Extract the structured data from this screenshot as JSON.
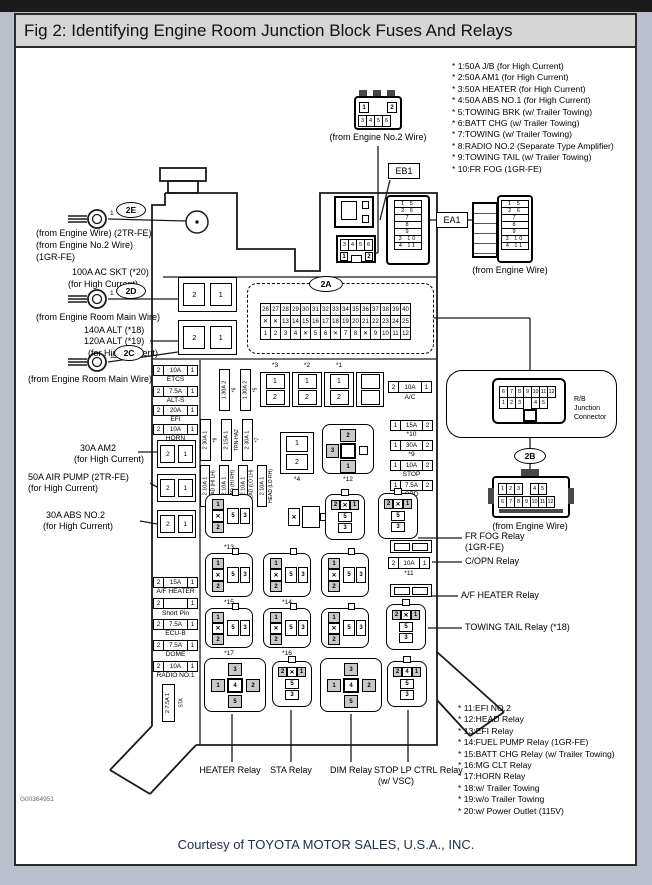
{
  "window": {
    "title": "Fig 2: Identifying Engine Room Junction Block Fuses And Relays"
  },
  "footer": {
    "credit": "Courtesy of TOYOTA MOTOR SALES, U.S.A., INC.",
    "doc_id": "G00364951"
  },
  "legend_top": [
    "* 1:50A J/B (for High Current)",
    "* 2:50A AM1 (for High Current)",
    "* 3:50A HEATER (for High Current)",
    "* 4:50A ABS NO.1 (for High Current)",
    "* 5:TOWING BRK (w/ Trailer Towing)",
    "* 6:BATT CHG (w/ Trailer Towing)",
    "* 7:TOWING (w/ Trailer Towing)",
    "* 8:RADIO NO.2 (Separate Type Amplifier)",
    "* 9:TOWING TAIL (w/ Trailer Towing)",
    "* 10:FR FOG (1GR-FE)"
  ],
  "legend_bottom": [
    "* 11:EFI NO.2",
    "* 12:HEAD Relay",
    "* 13:EFI Relay",
    "* 14:FUEL PUMP Relay (1GR-FE)",
    "* 15:BATT CHG Relay (w/ Trailer Towing)",
    "* 16:MG CLT Relay",
    "* 17:HORN Relay",
    "* 18:w/ Trailer Towing",
    "* 19:w/o Trailer Towing",
    "* 20:w/ Power Outlet (115V)"
  ],
  "ovals": {
    "e": "2E",
    "d": "2D",
    "c": "2C",
    "a": "2A",
    "b": "2B"
  },
  "ring_pin": "1",
  "left": {
    "engine_wire_1": "(from Engine Wire) (2TR-FE)",
    "engine_wire_2": "(from Engine No.2 Wire)",
    "engine_wire_3": "(1GR-FE)",
    "ac_skt_1": "100A AC SKT (*20)",
    "ac_skt_2": "(for High Current)",
    "main_wire_1": "(from Engine Room Main Wire)",
    "alt_1": "140A ALT (*18)",
    "alt_2": "120A ALT (*19)",
    "alt_3": "(for High Current)",
    "main_wire_2": "(from Engine Room Main Wire)",
    "am2_1": "30A AM2",
    "am2_2": "(for High Current)",
    "air_pump_1": "50A AIR PUMP (2TR-FE)",
    "air_pump_2": "(for High Current)",
    "abs_1": "30A ABS NO.2",
    "abs_2": "(for High Current)"
  },
  "top_conn": {
    "caption": "(from Engine No.2 Wire)",
    "eb1": "EB1",
    "p1": "1",
    "p2": "2",
    "row2": [
      "3",
      "4",
      "5",
      "6"
    ]
  },
  "eb1b": {
    "row1": [
      "3",
      "4",
      "5",
      "6"
    ],
    "p1": "1",
    "p2": "2"
  },
  "ea1": {
    "label": "EA1",
    "caption": "(from Engine Wire)",
    "rows": [
      "1 5",
      "2 6",
      "7",
      "8",
      "9",
      "3 10",
      "4 11"
    ]
  },
  "a2": {
    "row1": [
      "26",
      "27",
      "28",
      "29",
      "30",
      "31",
      "32",
      "33",
      "34",
      "35",
      "36",
      "37",
      "38",
      "39",
      "40"
    ],
    "row2": [
      "✕",
      "✕",
      "13",
      "14",
      "15",
      "16",
      "17",
      "18",
      "19",
      "20",
      "21",
      "22",
      "23",
      "24",
      "25"
    ],
    "row3": [
      "1",
      "2",
      "3",
      "4",
      "✕",
      "5",
      "6",
      "✕",
      "7",
      "8",
      "✕",
      "9",
      "10",
      "11",
      "12"
    ]
  },
  "rb": {
    "line1": "R/B",
    "line2": "Junction",
    "line3": "Connector",
    "row1": [
      "6",
      "7",
      "8",
      "9",
      "10",
      "11",
      "12"
    ],
    "row2": [
      {
        "t": "1"
      },
      {
        "t": "2"
      },
      {
        "t": "3"
      },
      {
        "t": "",
        "c": "gap"
      },
      {
        "t": "4"
      },
      {
        "t": "5"
      }
    ]
  },
  "b2conn": {
    "caption": "(from Engine Wire)",
    "row1": [
      {
        "t": "1"
      },
      {
        "t": "2"
      },
      {
        "t": "3"
      },
      {
        "t": "",
        "c": "gap"
      },
      {
        "t": "4"
      },
      {
        "t": "5"
      }
    ],
    "row2": [
      "6",
      "7",
      "8",
      "9",
      "10",
      "11",
      "12"
    ]
  },
  "right_callouts": {
    "fr_fog_1": "FR FOG Relay",
    "fr_fog_2": "(1GR-FE)",
    "c_opn": "C/OPN Relay",
    "af_heater": "A/F HEATER Relay",
    "towing_tail": "TOWING TAIL Relay (*18)"
  },
  "bottom_callouts": {
    "heater": "HEATER Relay",
    "sta": "STA Relay",
    "dim": "DIM Relay",
    "stop_1": "STOP LP CTRL Relay",
    "stop_2": "(w/ VSC)"
  },
  "fuses": {
    "etcs": {
      "p1": "2",
      "amp": "10A",
      "p2": "1",
      "n": "ETCS"
    },
    "alt_s": {
      "p1": "2",
      "amp": "7.5A",
      "p2": "1",
      "n": "ALT-S"
    },
    "efi": {
      "p1": "2",
      "amp": "20A",
      "p2": "1",
      "n": "EFI"
    },
    "horn": {
      "p1": "2",
      "amp": "10A",
      "p2": "1",
      "n": "HORN"
    },
    "af_heater": {
      "p1": "2",
      "amp": "15A",
      "p2": "1",
      "n": "A/F HEATER"
    },
    "short_pin": {
      "p1": "2",
      "amp": "",
      "p2": "1",
      "n": "Short Pin"
    },
    "ecu_b": {
      "p1": "2",
      "amp": "7.5A",
      "p2": "1",
      "n": "ECU-B"
    },
    "dome": {
      "p1": "2",
      "amp": "7.5A",
      "p2": "1",
      "n": "DOME"
    },
    "radio1": {
      "p1": "2",
      "amp": "10A",
      "p2": "1",
      "n": "RADIO NO.1"
    },
    "sta": {
      "r": "2 7.5A 1",
      "n": "STA"
    },
    "ac": {
      "p1": "2",
      "amp": "10A",
      "p2": "1",
      "n": "A/C"
    },
    "f10": {
      "p1": "1",
      "amp": "15A",
      "p2": "2",
      "n": "*10"
    },
    "f9": {
      "p1": "1",
      "amp": "30A",
      "p2": "2",
      "n": "*9"
    },
    "stop": {
      "p1": "1",
      "amp": "10A",
      "p2": "2",
      "n": "STOP"
    },
    "obd": {
      "p1": "1",
      "amp": "7.5A",
      "p2": "2",
      "n": "OBD"
    },
    "f11": {
      "p1": "2",
      "amp": "10A",
      "p2": "1",
      "n": "*11"
    },
    "v6": {
      "r": "1 30A 2",
      "n": "*6"
    },
    "v5": {
      "r": "1 30A 2",
      "n": "*5"
    },
    "v8": {
      "r": "2 30A 1",
      "n": "*8"
    },
    "trn": {
      "r": "2 15A 1",
      "n": "TRN-HAZ"
    },
    "v7": {
      "r": "2 30A 1",
      "n": "*7"
    },
    "head1": {
      "r": "2 10A 1",
      "n": "HEAD (HI LH)"
    },
    "head2": {
      "r": "2 10A 1",
      "n": "HEAD (HI RH)"
    },
    "head3": {
      "r": "2 10A 1",
      "n": "HEAD (LO LH)"
    },
    "head4": {
      "r": "2 10A 1",
      "n": "HEAD (LO RH)"
    }
  },
  "blocks": {
    "b3": "*3",
    "b2": "*2",
    "b1": "*1",
    "b0": "",
    "b4": "*4",
    "c1": "1",
    "c2": "2"
  },
  "hc": {
    "left": "2",
    "right": "1"
  },
  "relays": {
    "labels": {
      "r12": "*12",
      "r13": "*13",
      "r14": "*14",
      "r15": "*15",
      "r16": "*16",
      "r17": "*17"
    },
    "typeA": {
      "top": "1",
      "mid": "✕",
      "bot": "2",
      "p5": "5",
      "p3": "3"
    },
    "typeB": {
      "l": "2",
      "m": "✕",
      "r": "1",
      "c1": "5",
      "c2": "3"
    },
    "typeB2": {
      "l": "2",
      "m": "4",
      "r": "1",
      "c1": "5",
      "c2": "3"
    },
    "cross": {
      "top": "3",
      "left": "1",
      "center": "4",
      "right": "2",
      "bottom": "5"
    },
    "r12": {
      "top": "2",
      "left": "3",
      "bottom": "1"
    },
    "x": "✕"
  }
}
